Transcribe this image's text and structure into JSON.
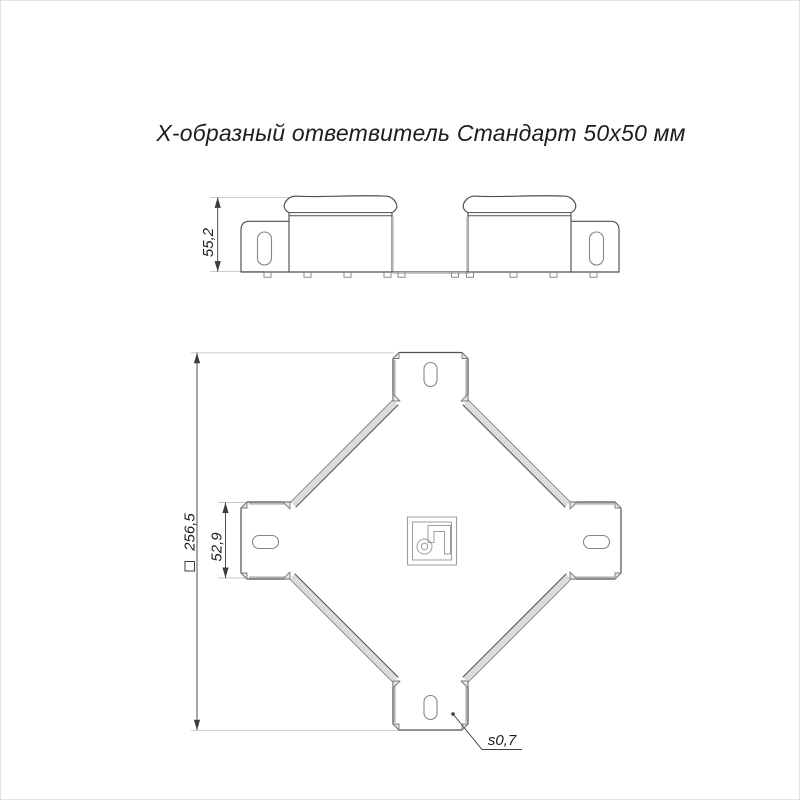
{
  "title": "Х-образный ответвитель Стандарт 50х50 мм",
  "views": {
    "side": {
      "height_dim": "55,2"
    },
    "plan": {
      "overall_dim_symbol": "□",
      "overall_dim_value": "256,5",
      "arm_width_dim": "52,9",
      "thickness_note": "s0,7"
    }
  },
  "icons": {
    "logo": "manufacturer-logo-monogram",
    "overall_dim_prefix": "square-outline-symbol",
    "thickness_leader_origin": "leader-dot"
  },
  "colors": {
    "bg": "#ffffff",
    "border": "#e3e3e3",
    "text": "#1d1d1d",
    "line": "#4f4f4f",
    "dim": "#3c3c3c",
    "ext": "#c6c6c6",
    "gray": "#b5b5b5",
    "band": "#dcdcdc",
    "trifill": "#e6e6e6",
    "tristroke": "#7a7a7a",
    "slot": "#858585",
    "logo": "#9c9c9c"
  }
}
